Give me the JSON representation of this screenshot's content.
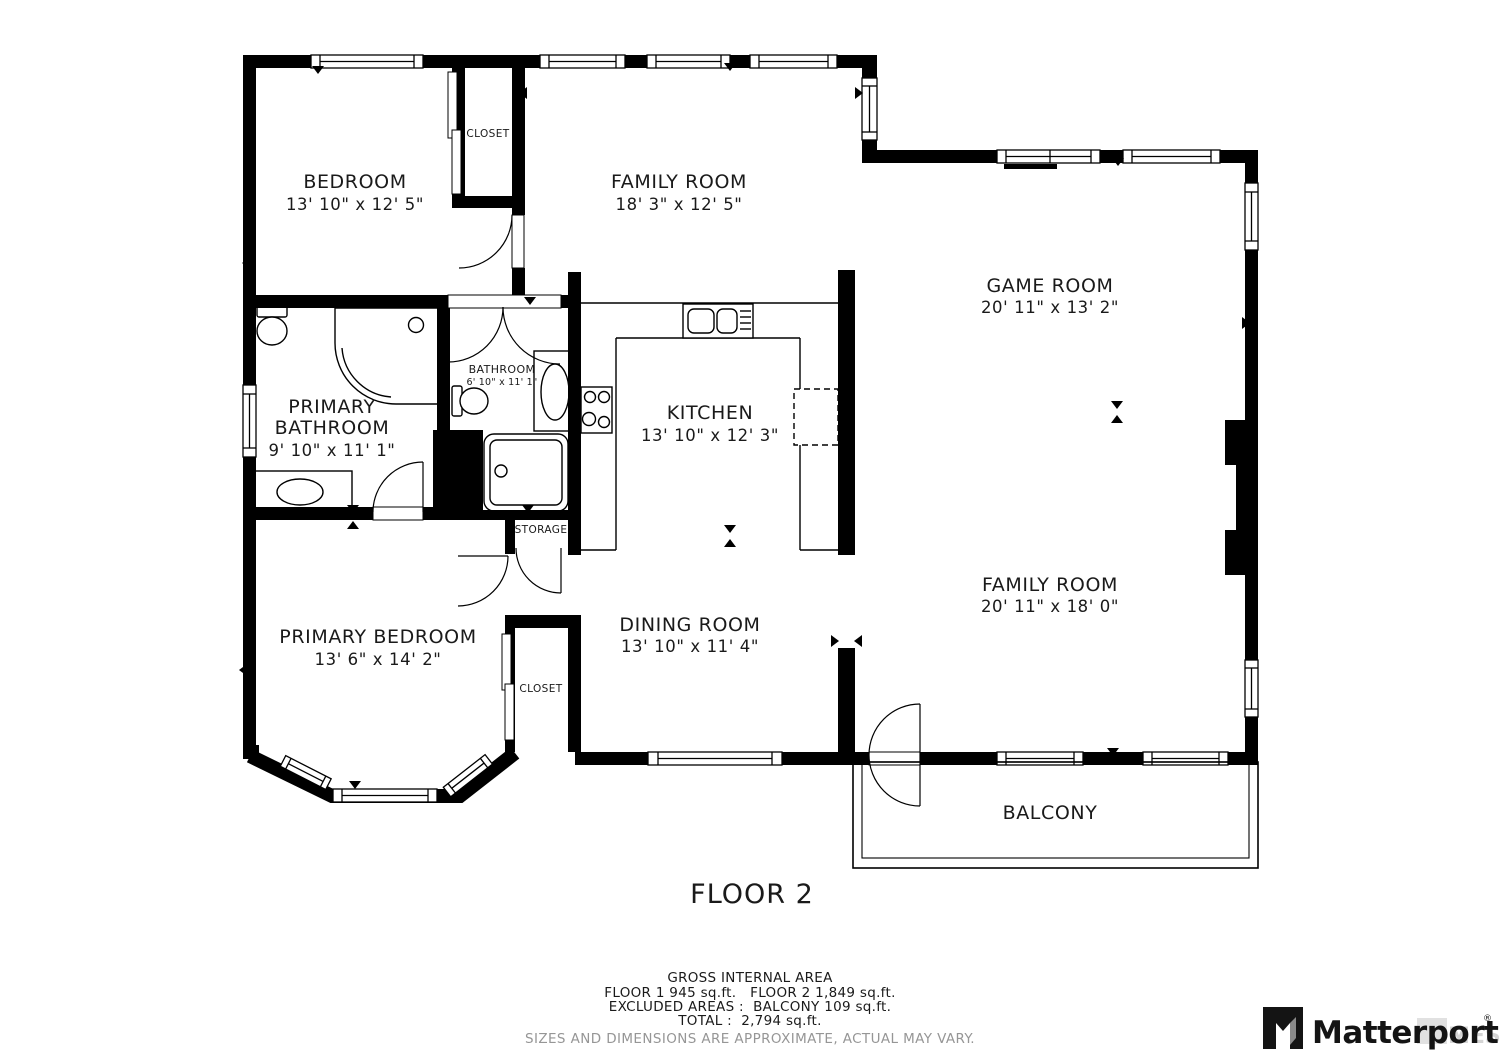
{
  "floor": {
    "label": "FLOOR 2"
  },
  "rooms": {
    "bedroom": {
      "name": "BEDROOM",
      "dims": "13' 10\" x 12' 5\""
    },
    "family_room_top": {
      "name": "FAMILY ROOM",
      "dims": "18' 3\" x 12' 5\""
    },
    "game_room": {
      "name": "GAME ROOM",
      "dims": "20' 11\" x 13' 2\""
    },
    "primary_bathroom": {
      "name_line1": "PRIMARY",
      "name_line2": "BATHROOM",
      "dims": "9' 10\" x 11' 1\""
    },
    "bathroom": {
      "name": "BATHROOM",
      "dims": "6' 10\" x 11' 1\""
    },
    "kitchen": {
      "name": "KITCHEN",
      "dims": "13' 10\" x 12' 3\""
    },
    "primary_bedroom": {
      "name": "PRIMARY BEDROOM",
      "dims": "13' 6\" x 14' 2\""
    },
    "dining_room": {
      "name": "DINING ROOM",
      "dims": "13' 10\" x 11' 4\""
    },
    "family_room_main": {
      "name": "FAMILY ROOM",
      "dims": "20' 11\" x 18' 0\""
    },
    "balcony": {
      "name": "BALCONY"
    },
    "closet_top": {
      "name": "CLOSET"
    },
    "closet_bottom": {
      "name": "CLOSET"
    },
    "storage": {
      "name": "STORAGE"
    }
  },
  "footer": {
    "title": "GROSS INTERNAL AREA",
    "line1": "FLOOR 1 945 sq.ft.   FLOOR 2 1,849 sq.ft.",
    "line2": "EXCLUDED AREAS :  BALCONY 109 sq.ft.",
    "line3": "TOTAL :  2,794 sq.ft.",
    "disclaimer": "SIZES AND DIMENSIONS ARE APPROXIMATE, ACTUAL MAY VARY."
  },
  "branding": {
    "logo_text": "Matterport",
    "registered": "®",
    "watermark": "MES"
  },
  "colors": {
    "wall": "#000000",
    "text": "#1a1a1a",
    "muted": "#969696"
  }
}
